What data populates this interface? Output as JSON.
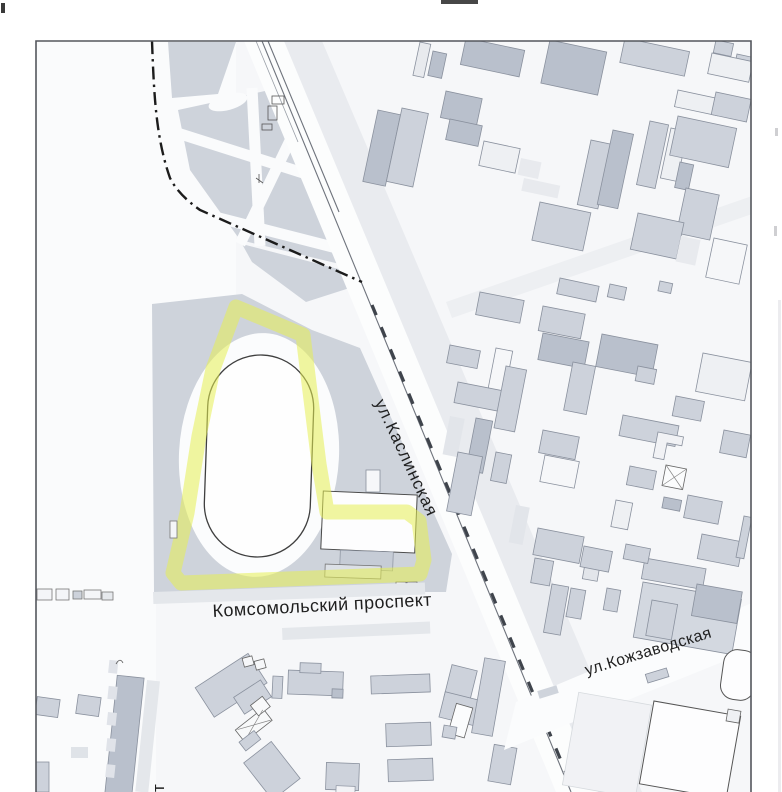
{
  "map": {
    "street_labels": {
      "kaslinskaya": "ул.Каслинская",
      "komsomolskiy": "Комсомольский проспект",
      "kozhzavodskaya": "ул.Кожзаводская",
      "vertical_fragment": "т"
    },
    "features": {
      "highlighted_parcel": "yellow highlighter outline around stadium block",
      "stadium": "oval running track",
      "boundary": "dash-dot district boundary line",
      "railway": "railway line along ул.Каслинская"
    },
    "colors": {
      "highlight": "#e6ee52",
      "building_fill": "#cdd2db",
      "building_dark": "#b9c0cc",
      "building_stroke": "#8a919e",
      "block_fill": "#ced3db",
      "frame": "#54575d",
      "rail": "#6e737c",
      "boundary": "#1c1c1c",
      "label_text": "#1f1f1f"
    }
  }
}
